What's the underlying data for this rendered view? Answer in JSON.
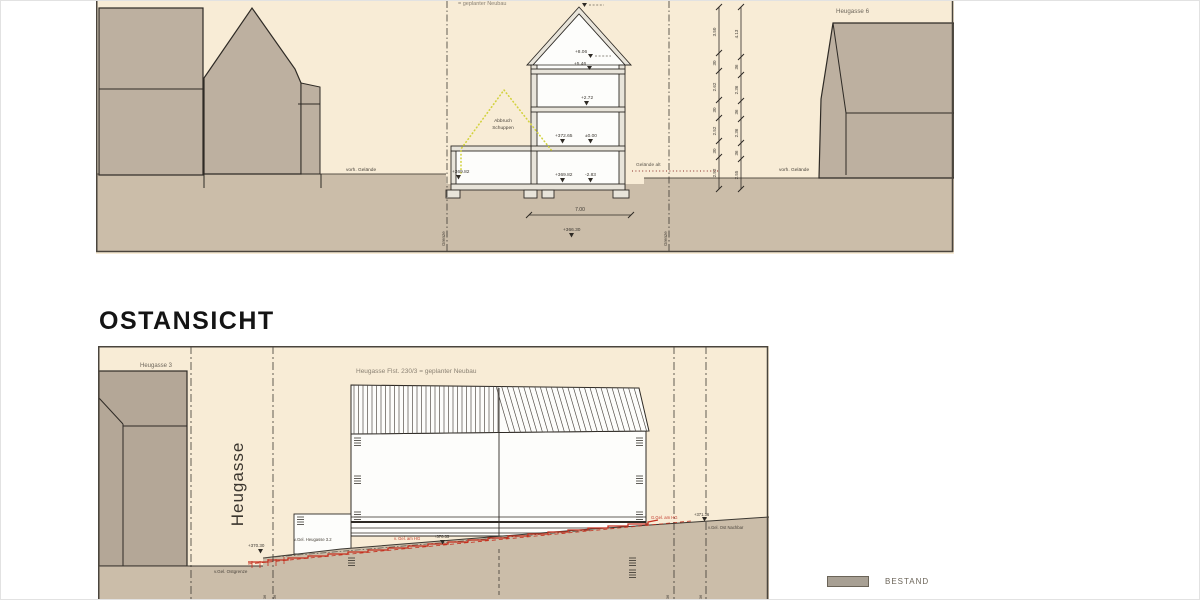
{
  "east_view": {
    "heading": "OSTANSICHT",
    "neighbor_left_label": "Heugasse 3",
    "street_name": "Heugasse",
    "building_label": "Heugasse Flst. 230/3 = geplanter Neubau",
    "ground_east_boundary_label": "v.Gel. Ostgrenze",
    "street_level_label": "v.Gel. Heugasse 3.2",
    "street_level_value": "+370.30",
    "existing_ground_hg_label": "v. Gel. am HG",
    "existing_ground_hg_value": "+370.35",
    "planned_ground_hg_label": "G.Gel. am HG",
    "planned_ground_hg_value": "+371.36",
    "neighbor_ground_label": "v.Gel. Ost Nachbar",
    "tick_labels": [
      "36",
      "36",
      "36",
      "36"
    ]
  },
  "section": {
    "top_label": "= geplanter Neubau",
    "neighbor_right_label": "Heugasse 6",
    "ground_label_left": "vorh. Gelände",
    "ground_label_right": "vorh. Gelände",
    "ground_old_label": "Gelände alt",
    "demolition_label_line1": "Abbruch",
    "demolition_label_line2": "Schuppen",
    "boundary_label_left": "Grenze",
    "boundary_label_right": "Grenze",
    "width_dim": "7.00",
    "levels": {
      "ridge": "+8.06",
      "eaves": "+5.46",
      "upper_floor": "+2.72",
      "ground_floor_abs": "+372.65",
      "ground_floor_rel": "±0.00",
      "basement_abs": "+369.82",
      "basement_rel": "-2.83",
      "annex_floor": "+369.82",
      "foundation": "+366.30"
    },
    "dim_chain_left": [
      "3.50",
      "30",
      "2.62",
      "30",
      "2.52",
      "30",
      "2.52"
    ],
    "dim_chain_right": [
      "4.13",
      "36",
      "2.36",
      "36",
      "2.36",
      "36",
      "2.55"
    ]
  },
  "legend": {
    "bestand_label": "BESTAND",
    "bestand_color": "#a8a094"
  },
  "colors": {
    "panel_background": "#f8ecd6",
    "ground_fill": "#cbbda9",
    "existing_building_fill": "#bdb0a0",
    "drawing_line": "#2e2a25",
    "planned_ground_red": "#c5301f",
    "demolition_yellow": "#d2d23e"
  }
}
